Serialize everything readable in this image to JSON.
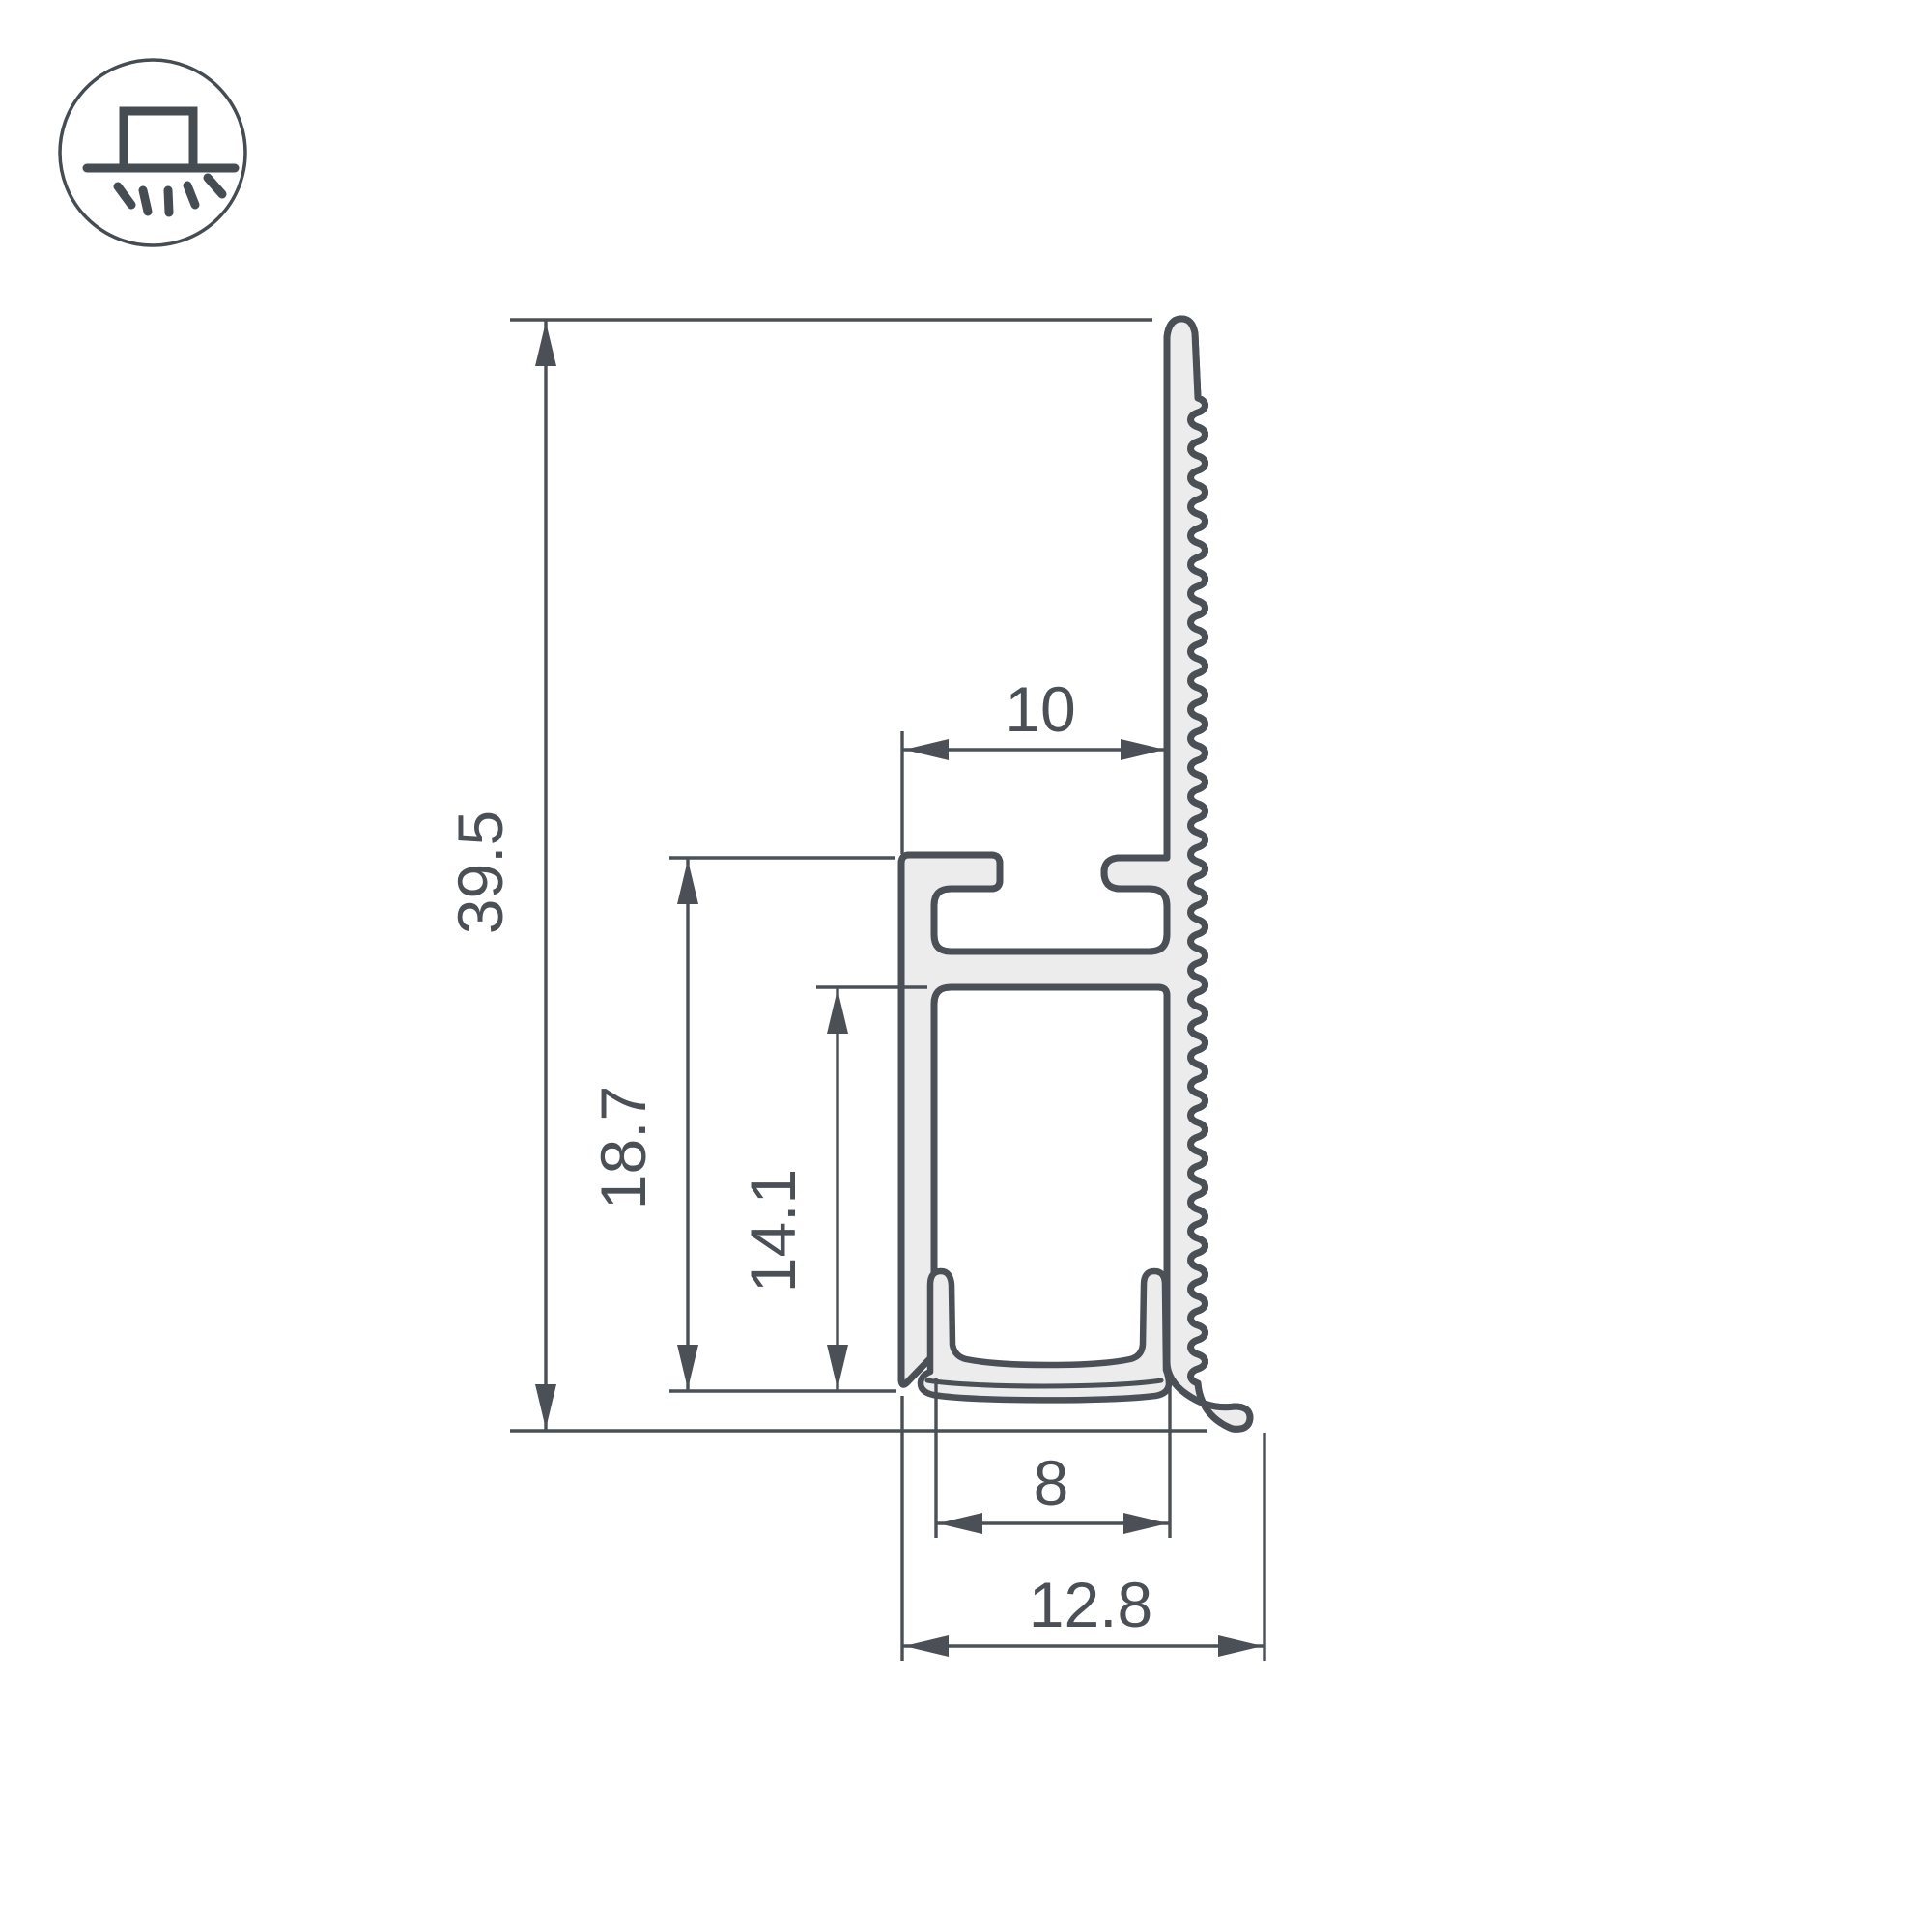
{
  "drawing": {
    "kind": "led-profile-cross-section",
    "units": "mm",
    "dims": {
      "overall_height": "39.5",
      "flange_height": "18.7",
      "channel_height": "14.1",
      "top_slot_width": "10",
      "inner_width": "8",
      "overall_width": "12.8"
    },
    "icon": {
      "name": "recessed-downlight-icon"
    },
    "colors": {
      "line": "#4A5056",
      "fill": "#ECECEC",
      "background": "#FFFFFF"
    }
  }
}
